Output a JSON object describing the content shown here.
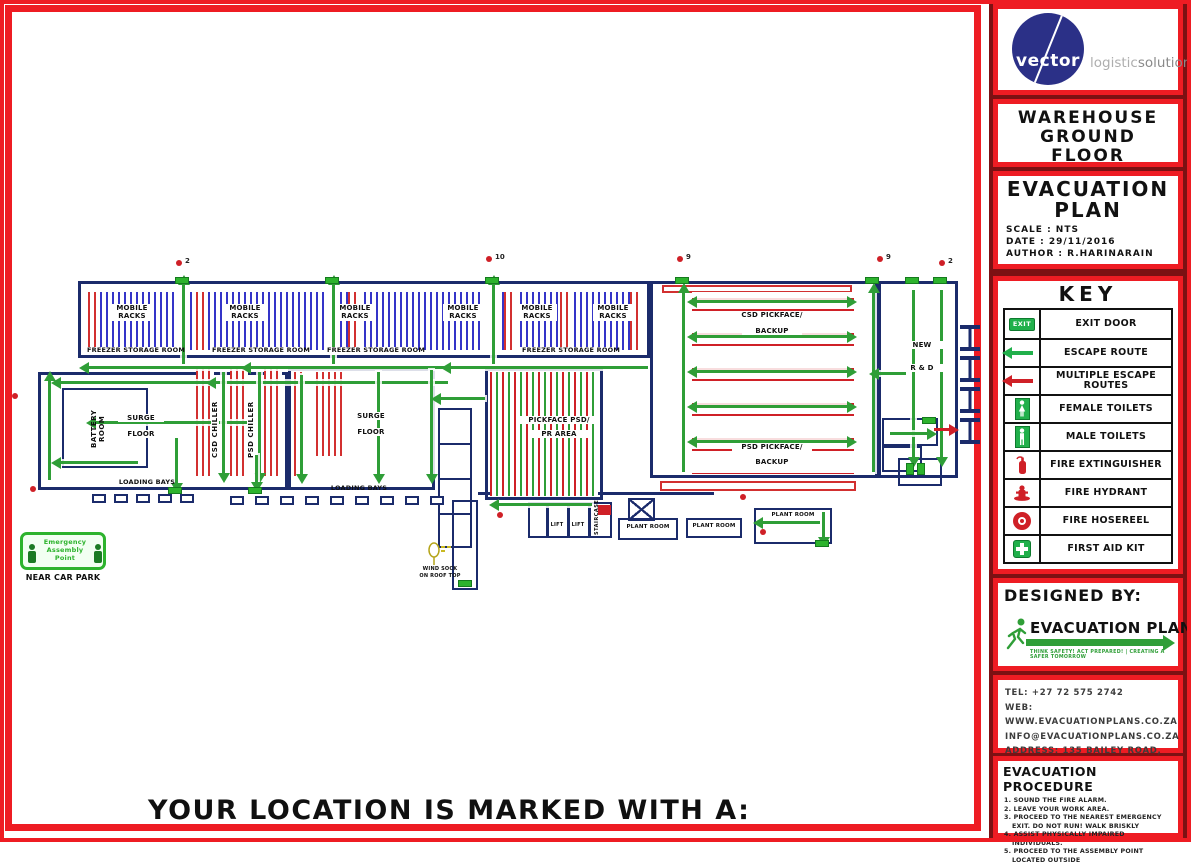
{
  "page": {
    "location_note": "YOUR LOCATION IS MARKED WITH A:"
  },
  "brand": {
    "circle_text": "vector",
    "tagline_light": "logistic",
    "tagline_dark": "solutions"
  },
  "title_panel": {
    "line1": "WAREHOUSE",
    "line2": "GROUND",
    "line3": "FLOOR"
  },
  "plan_panel": {
    "title_line1": "EVACUATION",
    "title_line2": "PLAN",
    "scale": "SCALE : NTS",
    "date": "DATE : 29/11/2016",
    "author": "AUTHOR : R.HARINARAIN"
  },
  "key": {
    "title": "KEY",
    "exit_icon_text": "EXIT",
    "items": [
      {
        "icon": "exit-door-icon",
        "label": "EXIT DOOR"
      },
      {
        "icon": "escape-route-arrow-icon",
        "label": "ESCAPE ROUTE"
      },
      {
        "icon": "multiple-escape-routes-arrow-icon",
        "label": "MULTIPLE ESCAPE ROUTES"
      },
      {
        "icon": "female-toilets-icon",
        "label": "FEMALE TOILETS"
      },
      {
        "icon": "male-toilets-icon",
        "label": "MALE TOILETS"
      },
      {
        "icon": "fire-extinguisher-icon",
        "label": "FIRE EXTINGUISHER"
      },
      {
        "icon": "fire-hydrant-icon",
        "label": "FIRE HYDRANT"
      },
      {
        "icon": "fire-hosereel-icon",
        "label": "FIRE HOSEREEL"
      },
      {
        "icon": "first-aid-kit-icon",
        "label": "FIRST AID KIT"
      }
    ]
  },
  "designed_by": {
    "heading": "DESIGNED BY:",
    "logo_text": "EVACUATION PLANS",
    "tagline": "THINK SAFETY! ACT PREPARED! | CREATING A SAFER TOMORROW"
  },
  "contact": {
    "tel": "TEL: +27 72 575 2742",
    "web": "WEB: WWW.EVACUATIONPLANS.CO.ZA",
    "email": "INFO@EVACUATIONPLANS.CO.ZA",
    "address1": "ADDRESS: 135 BAILEY ROAD,",
    "address2": "REHILL, DURBAN, 4051"
  },
  "procedure": {
    "title": "EVACUATION PROCEDURE",
    "steps": [
      "1. SOUND THE FIRE ALARM.",
      "2. LEAVE YOUR WORK AREA.",
      "3. PROCEED TO THE NEAREST EMERGENCY EXIT. DO NOT RUN! WALK BRISKLY",
      "4. ASSIST PHYSICALLY IMPAIRED INDIVIDUALS.",
      "5. PROCEED TO THE ASSEMBLY POINT LOCATED OUTSIDE"
    ]
  },
  "plan": {
    "mobile_racks": "MOBILE RACKS",
    "freezer_storage_room": "FREEZER STORAGE ROOM",
    "csd_pickface": "CSD PICKFACE/",
    "psd_pickface": "PSD PICKFACE/",
    "backup": "BACKUP",
    "new_label": "NEW",
    "r_and_d": "R & D",
    "battery_room": "BATTERY ROOM",
    "surge": "SURGE",
    "floor": "FLOOR",
    "csd_chiller": "CSD CHILLER",
    "psd_chiller": "PSD CHILLER",
    "loading_bays": "LOADING BAYS",
    "pickface_psd": "PICKFACE PSD/",
    "pr_area": "PR AREA",
    "lift": "LIFT",
    "staircase": "STAIRCASE",
    "plant_room": "PLANT ROOM",
    "wind_sock_1": "WIND SOCK",
    "wind_sock_2": "ON ROOF TOP",
    "assembly_point": "Emergency Assembly Point",
    "near_car_park": "NEAR CAR PARK",
    "markers": {
      "m1": "2",
      "m2": "10",
      "m3": "9",
      "m4": "9",
      "m5": "2"
    }
  }
}
